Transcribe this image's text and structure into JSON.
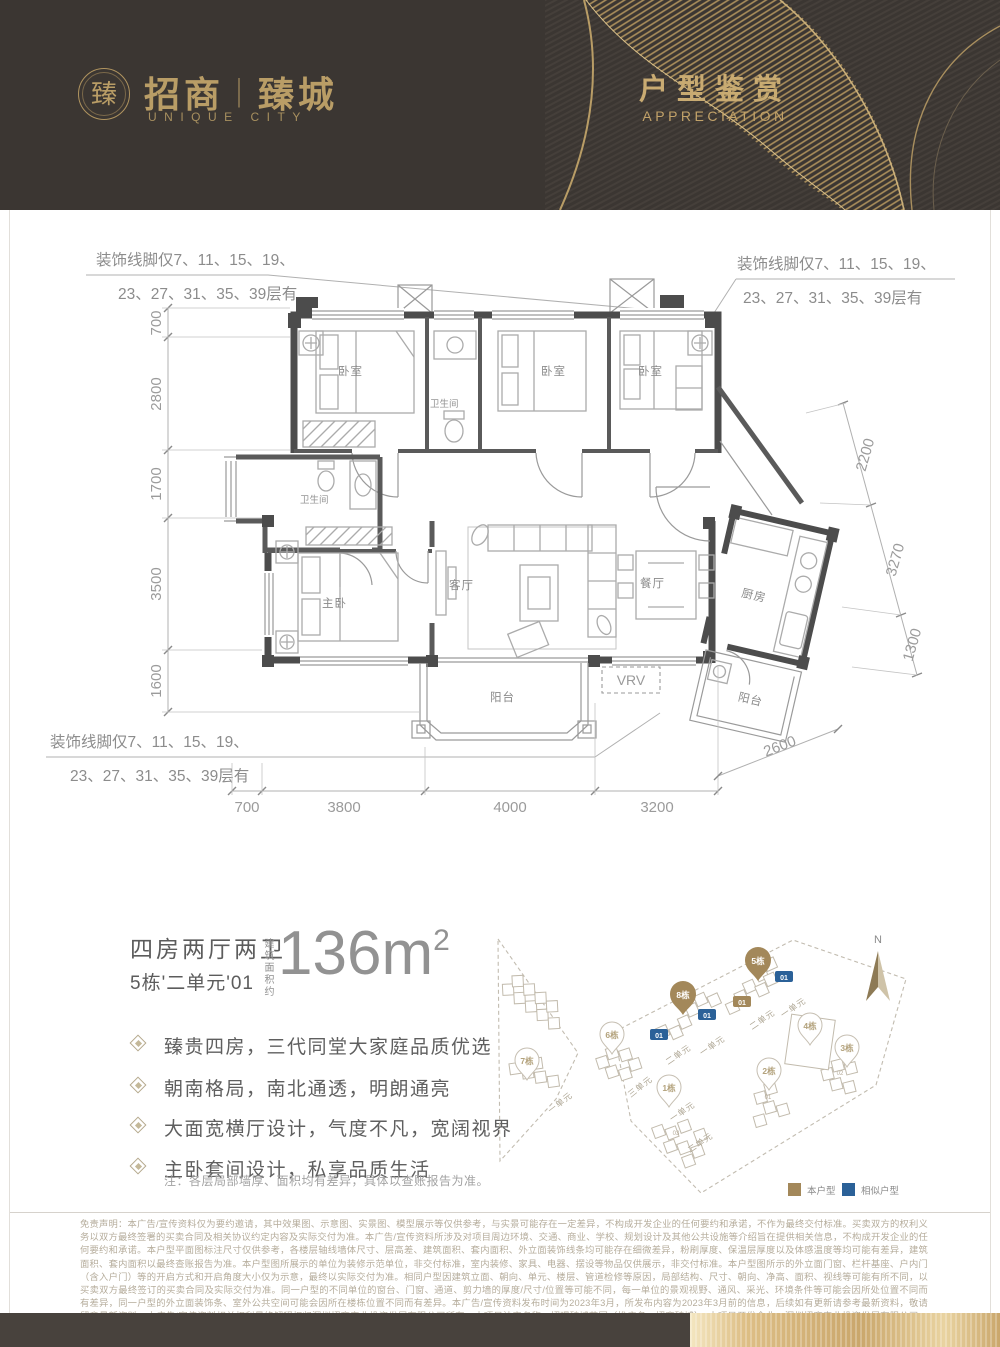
{
  "header": {
    "emblem_char": "臻",
    "brand_left": "招商",
    "brand_divider": "｜",
    "brand_right": "臻城",
    "brand_sub": "UNIQUE CITY",
    "title": "户型鉴赏",
    "subtitle": "APPRECIATION"
  },
  "floor_plan": {
    "note_lines": {
      "l1": "装饰线脚仅7、11、15、19、",
      "l2": "23、27、31、35、39层有"
    },
    "rooms": {
      "bedroom": "卧室",
      "master": "主卧",
      "bath": "卫生间",
      "living": "客厅",
      "dining": "餐厅",
      "kitchen": "厨房",
      "balcony": "阳台",
      "vrv": "VRV"
    },
    "dims": {
      "left": [
        "700",
        "2800",
        "1700",
        "3500",
        "1600"
      ],
      "bottom": [
        "700",
        "3800",
        "4000",
        "3200"
      ],
      "bottom_right": "2600",
      "right": [
        "2200",
        "3270",
        "1300"
      ]
    }
  },
  "unit": {
    "layout": "四房两厅两卫",
    "number": "5栋'二单元'01",
    "area_label": "建筑面积约",
    "area_value": "136m",
    "area_sup": "2",
    "features": [
      "臻贵四房，三代同堂大家庭品质优选",
      "朝南格局，南北通透，明朗通亮",
      "大面宽横厅设计，气度不凡，宽阔视界",
      "主卧套间设计，私享品质生活"
    ],
    "note": "注：各层局部墙厚、面积均有差异，具体以查账报告为准。"
  },
  "site_map": {
    "north": "N",
    "pins": [
      {
        "label": "7栋"
      },
      {
        "label": "6栋"
      },
      {
        "label": "8栋"
      },
      {
        "label": "5栋"
      },
      {
        "label": "1栋"
      },
      {
        "label": "4栋"
      },
      {
        "label": "3栋"
      },
      {
        "label": "2栋"
      }
    ],
    "unit_labels": [
      "一单元",
      "三单元",
      "二单元",
      "一单元",
      "二单元",
      "一单元",
      "一单元",
      "二单元"
    ],
    "tag": "01",
    "building_unit_numbers": [
      "01",
      "02",
      "03"
    ],
    "legend": {
      "current": "本户型",
      "similar": "相似户型"
    },
    "colors": {
      "current": "#a3885a",
      "similar": "#2b6198",
      "gold_accent": "#bfa06a",
      "header_bg": "#3b3632"
    }
  },
  "disclaimer": {
    "text": "免责声明：本广告/宣传资料仅为要约邀请，其中效果图、示意图、实景图、模型展示等仅供参考，与实景可能存在一定差异，不构成开发企业的任何要约和承诺，不作为最终交付标准。买卖双方的权利义务以双方最终签署的买卖合同及相关协议约定内容及实际交付为准。本广告/宣传资料所涉及对项目周边环境、交通、商业、学校、规划设计及其他公共设施等介绍旨在提供相关信息，不构成开发企业的任何要约和承诺。本户型平面图标注尺寸仅供参考，各楼层轴线墙体尺寸、层高差、建筑面积、套内面积、外立面装饰线条均可能存在细微差异，粉刷厚度、保温层厚度以及体感温度等均可能有差异，建筑面积、套内面积以最终查账报告为准。本户型图所展示的单位为装修示范单位，非交付标准，室内装修、家具、电器、摆设等物品仅供展示，非交付标准。本户型图所示的外立面门窗、栏杆基座、户内门（含入户门）等的开启方式和开启角度大小仅为示意，最终以实际交付为准。相同户型因建筑立面、朝向、单元、楼层、管道检修等原因，局部结构、尺寸、朝向、净高、面积、视线等可能有所不同，以买卖双方最终签订的买卖合同及实际交付为准。同一户型的不同单位的窗台、门窗、通道、剪力墙的厚度/尺寸/位置等可能不同，每一单位的景观视野、通风、采光、环境条件等可能会因所处位置不同而有差异，同一户型的外立面装饰条、室外公共空间可能会因所在楼栋位置不同而有差异。本广告/宣传资料发布时间为2023年3月，所发布内容为2023年3月前的信息，后续如有更新请参考最新资料，敬请留意最新资料。本广告/宣传资料相关权利最终解释权归深圳招商安业投资发展有限公司所有。本项目法定名称：招璟臻城花园（推广名：招商臻城）。本项目开发企业：深圳招商安业投资发展有限公司。制作日期：2023年3月。"
  }
}
